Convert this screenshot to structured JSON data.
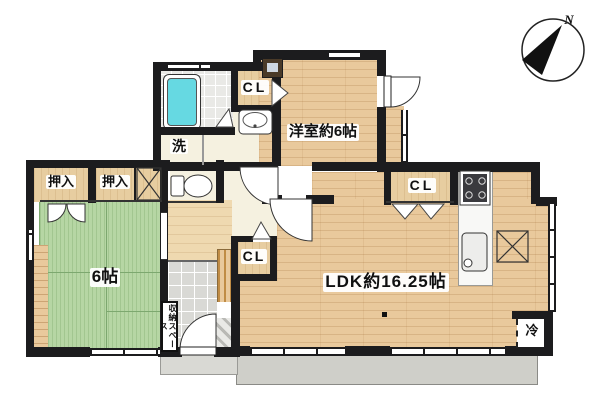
{
  "floor_plan": {
    "compass": {
      "north_label": "N"
    },
    "rooms": {
      "western_room": "洋室約6帖",
      "ldk": "LDK約16.25帖",
      "tatami_room": "6帖",
      "laundry": "洗",
      "refrigerator_space": "冷",
      "storage_space": "収納スペース",
      "closet_upper": "CL",
      "closet_hall": "CL",
      "closet_kitchen": "CL",
      "oshiire_left": "押入",
      "oshiire_right": "押入"
    },
    "fixtures": [
      "bathtub",
      "shower-room",
      "washbasin",
      "toilet",
      "kitchen-sink",
      "gas-stove",
      "water-heater",
      "entrance-door",
      "balcony"
    ],
    "colors": {
      "wall": "#1c1c1e",
      "wood": "#e9c99c",
      "wood_light": "#efd9b0",
      "closet": "#e7cda0",
      "tatami": "#b6d6a4",
      "tatami_line": "#7da86f",
      "bath": "#66d9e2",
      "shower": "#e9e9e6",
      "cream": "#f5f1e0",
      "genkan": "#d9d9d5",
      "balcony": "#cfcfc9",
      "porch": "#d9d9d4",
      "counter": "#f8f8f6"
    }
  }
}
